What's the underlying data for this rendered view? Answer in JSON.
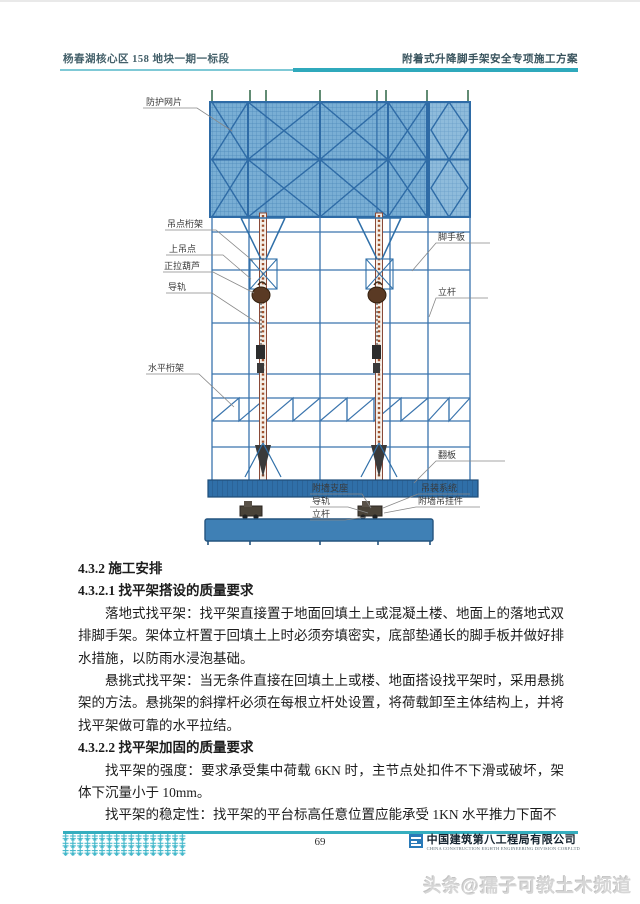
{
  "header": {
    "left": "杨春湖核心区 158 地块一期一标段",
    "right": "附着式升降脚手架安全专项施工方案"
  },
  "diagram": {
    "labels": {
      "protective_mesh": "防护网片",
      "lift_point_truss": "吊点桁架",
      "upper_lift_point": "上吊点",
      "hoist": "正拉葫芦",
      "guide_rail": "导轨",
      "horizontal_truss": "水平桁架",
      "scaffold_board": "脚手板",
      "vertical_pole": "立杆",
      "flip_board": "翻板",
      "wall_support": "附墙支座",
      "guide_rail_2": "导轨",
      "vertical_pole_2": "立杆",
      "hoisting_system": "吊装系统",
      "wall_hanger": "附墙吊挂件"
    }
  },
  "body": {
    "heading1": "4.3.2 施工安排",
    "heading2": "4.3.2.1 找平架搭设的质量要求",
    "para1": "落地式找平架：找平架直接置于地面回填土上或混凝土楼、地面上的落地式双排脚手架。架体立杆置于回填土上时必须夯填密实，底部垫通长的脚手板并做好排水措施，以防雨水浸泡基础。",
    "para2": "悬挑式找平架：当无条件直接在回填土上或楼、地面搭设找平架时，采用悬挑架的方法。悬挑架的斜撑杆必须在每根立杆处设置，将荷载卸至主体结构上，并将找平架做可靠的水平拉结。",
    "heading3": "4.3.2.2 找平架加固的质量要求",
    "para3": "找平架的强度：要求承受集中荷载 6KN 时，主节点处扣件不下滑或破坏，架体下沉量小于 10mm。",
    "para4": "找平架的稳定性：找平架的平台标高任意位置应能承受 1KN 水平推力下面不"
  },
  "footer": {
    "page_number": "69",
    "company_cn": "中国建筑第八工程局有限公司",
    "company_en": "CHINA CONSTRUCTION EIGHTH ENGINEERING DIVISION CORP.LTD"
  },
  "watermark": "头条@孺子可教土木频道",
  "colors": {
    "accent_teal": "#2fa9bc",
    "mesh_blue": "#6ea9d2",
    "frame_blue": "#3a74ad",
    "rail_brown": "#9c4a35",
    "board_blue": "#2f6fa8",
    "logo_blue": "#2a7ab8"
  }
}
